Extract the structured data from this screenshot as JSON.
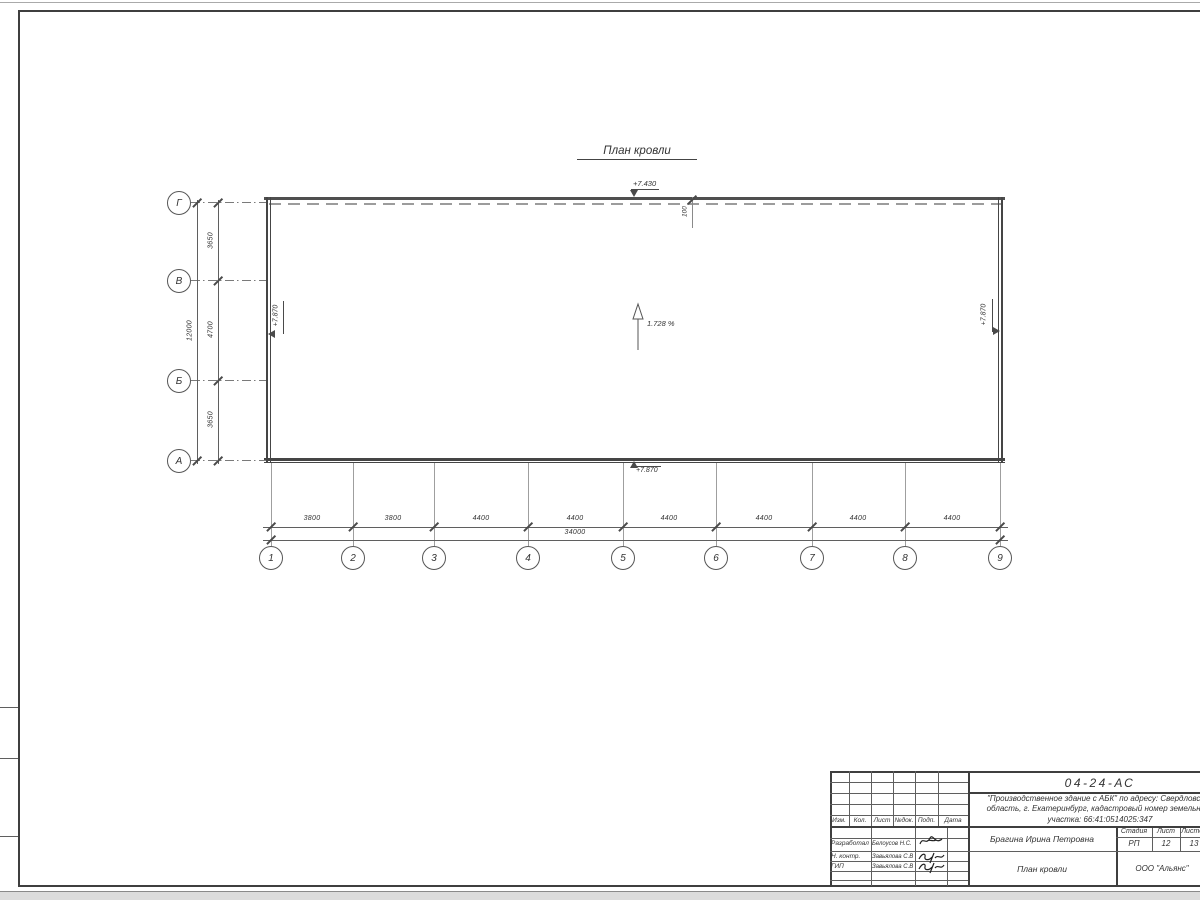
{
  "drawing": {
    "title": "План кровли",
    "slope_label": "1.728 %",
    "elevation_top": "+7.430",
    "elevation_left": "+7.870",
    "elevation_right": "+7.870",
    "elevation_bottom": "+7.870",
    "parapet_dim": "100",
    "axes_bottom": [
      "1",
      "2",
      "3",
      "4",
      "5",
      "6",
      "7",
      "8",
      "9"
    ],
    "axes_left": [
      "Г",
      "В",
      "Б",
      "А"
    ],
    "dims_bottom": [
      "3800",
      "3800",
      "4400",
      "4400",
      "4400",
      "4400",
      "4400",
      "4400"
    ],
    "dim_bottom_total": "34000",
    "dims_left": [
      "3650",
      "4700",
      "3650"
    ],
    "dim_left_total": "12000"
  },
  "titleblock": {
    "doc_number": "04-24-АС",
    "project_line1": "\"Производственное здание с АБК\" по адресу: Свердловская",
    "project_line2": "область, г. Екатеринбург, кадастровый номер земельного",
    "project_line3": "участка: 66:41:0514025:347",
    "header_cols": [
      "Изм.",
      "Кол.",
      "Лист",
      "№док.",
      "Подп.",
      "Дата"
    ],
    "rows": [
      {
        "role": "Разработал",
        "name": "Белоусов Н.С."
      },
      {
        "role": "Н. контр.",
        "name": "Завьялова С.В"
      },
      {
        "role": "ГИП",
        "name": "Завьялова С.В"
      }
    ],
    "customer_name": "Брагина Ирина Петровна",
    "sheet_title": "План кровли",
    "company": "ООО \"Альянс\"",
    "stage_header": [
      "Стадия",
      "Лист",
      "Листов"
    ],
    "stage_values": [
      "РП",
      "12",
      "13"
    ]
  }
}
